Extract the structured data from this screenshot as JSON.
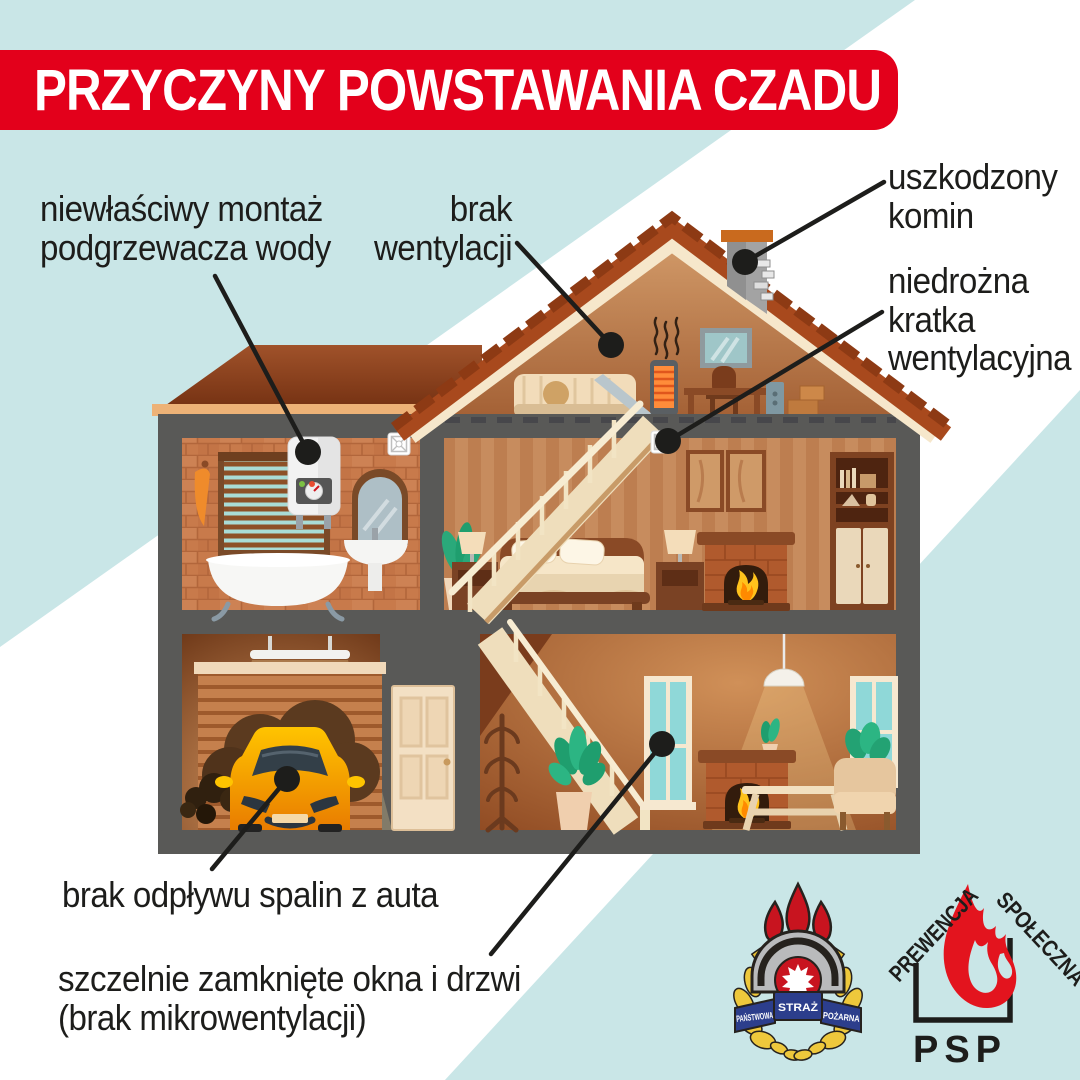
{
  "title": "PRZYCZYNY POWSTAWANIA CZADU",
  "callouts": {
    "water_heater": "niewłaściwy montaż\npodgrzewacza wody",
    "ventilation": "brak\nwentylacji",
    "chimney": "uszkodzony\nkomin",
    "vent_grille": "niedrożna\nkratka\nwentylacyjna",
    "car_exhaust": "brak odpływu spalin z auta",
    "windows": "szczelnie zamknięte okna i drzwi\n(brak mikrowentylacji)"
  },
  "logos": {
    "psp_crest": {
      "ribbon_left": "PAŃSTWOWA",
      "ribbon_center": "STRAŻ",
      "ribbon_right": "POŻARNA"
    },
    "prevention": {
      "roof_left": "PREWENCJA",
      "roof_right": "SPOŁECZNA",
      "abbr": "PSP"
    }
  },
  "colors": {
    "banner_red": "#e3001b",
    "background_teal": "#c9e6e7",
    "text_black": "#1d1d1b",
    "logo_red": "#d0151f",
    "ribbon_navy": "#2c3e8c"
  }
}
